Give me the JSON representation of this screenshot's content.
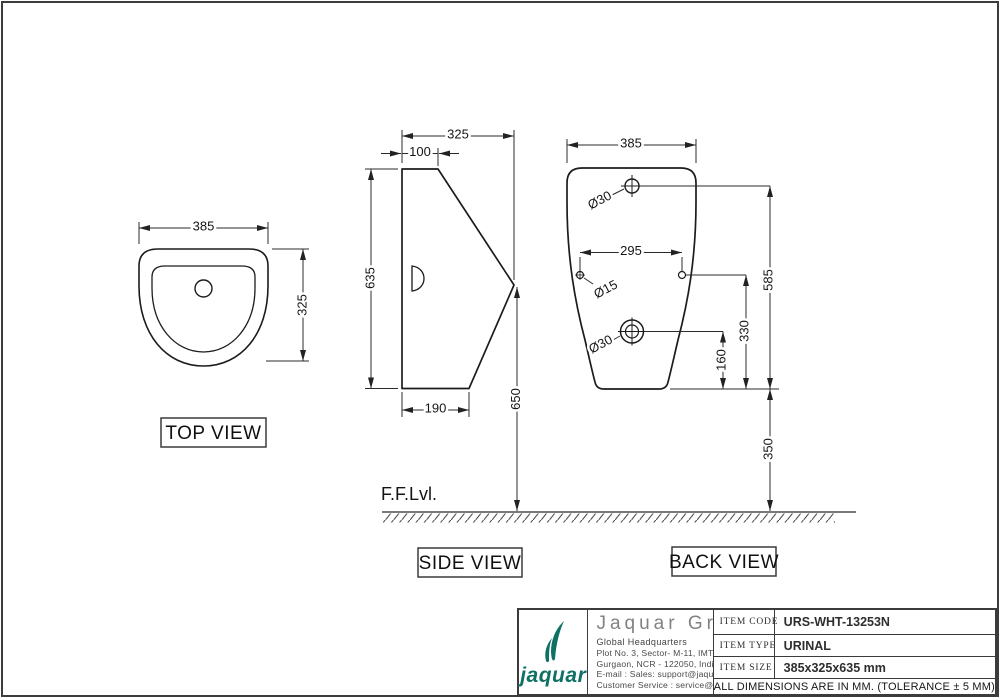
{
  "views": {
    "top": {
      "label": "TOP VIEW",
      "width_dim": "385",
      "depth_dim": "325"
    },
    "side": {
      "label": "SIDE VIEW",
      "depth_dim": "325",
      "top_flat_dim": "100",
      "height_dim": "635",
      "base_depth_dim": "190",
      "rim_height_dim": "650"
    },
    "back": {
      "label": "BACK VIEW",
      "width_dim": "385",
      "top_hole_dia": "Ø30",
      "holes_spacing_dim": "295",
      "small_hole_dia": "Ø15",
      "outlet_dia": "Ø30",
      "top_hole_height_dim": "585",
      "small_hole_height_dim": "330",
      "outlet_height_dim": "160",
      "mount_height_dim": "350"
    },
    "floor_label": "F.F.Lvl."
  },
  "title_block": {
    "brand_wordmark": "jaquar",
    "brand_color": "#0e7163",
    "company_name": "Jaquar Group",
    "headquarters": "Global Headquarters",
    "address_line1": "Plot No. 3, Sector- M-11, IMT Manesar",
    "address_line2": "Gurgaon, NCR - 122050, India",
    "email_line": "E-mail : Sales: support@jaquar.com",
    "service_line": "Customer Service : service@jaquar.com",
    "item_code_label": "ITEM CODE",
    "item_code": "URS-WHT-13253N",
    "item_type_label": "ITEM TYPE",
    "item_type": "URINAL",
    "item_size_label": "ITEM SIZE",
    "item_size": "385x325x635 mm",
    "note": "ALL DIMENSIONS ARE IN MM. (TOLERANCE ± 5 MM)"
  }
}
